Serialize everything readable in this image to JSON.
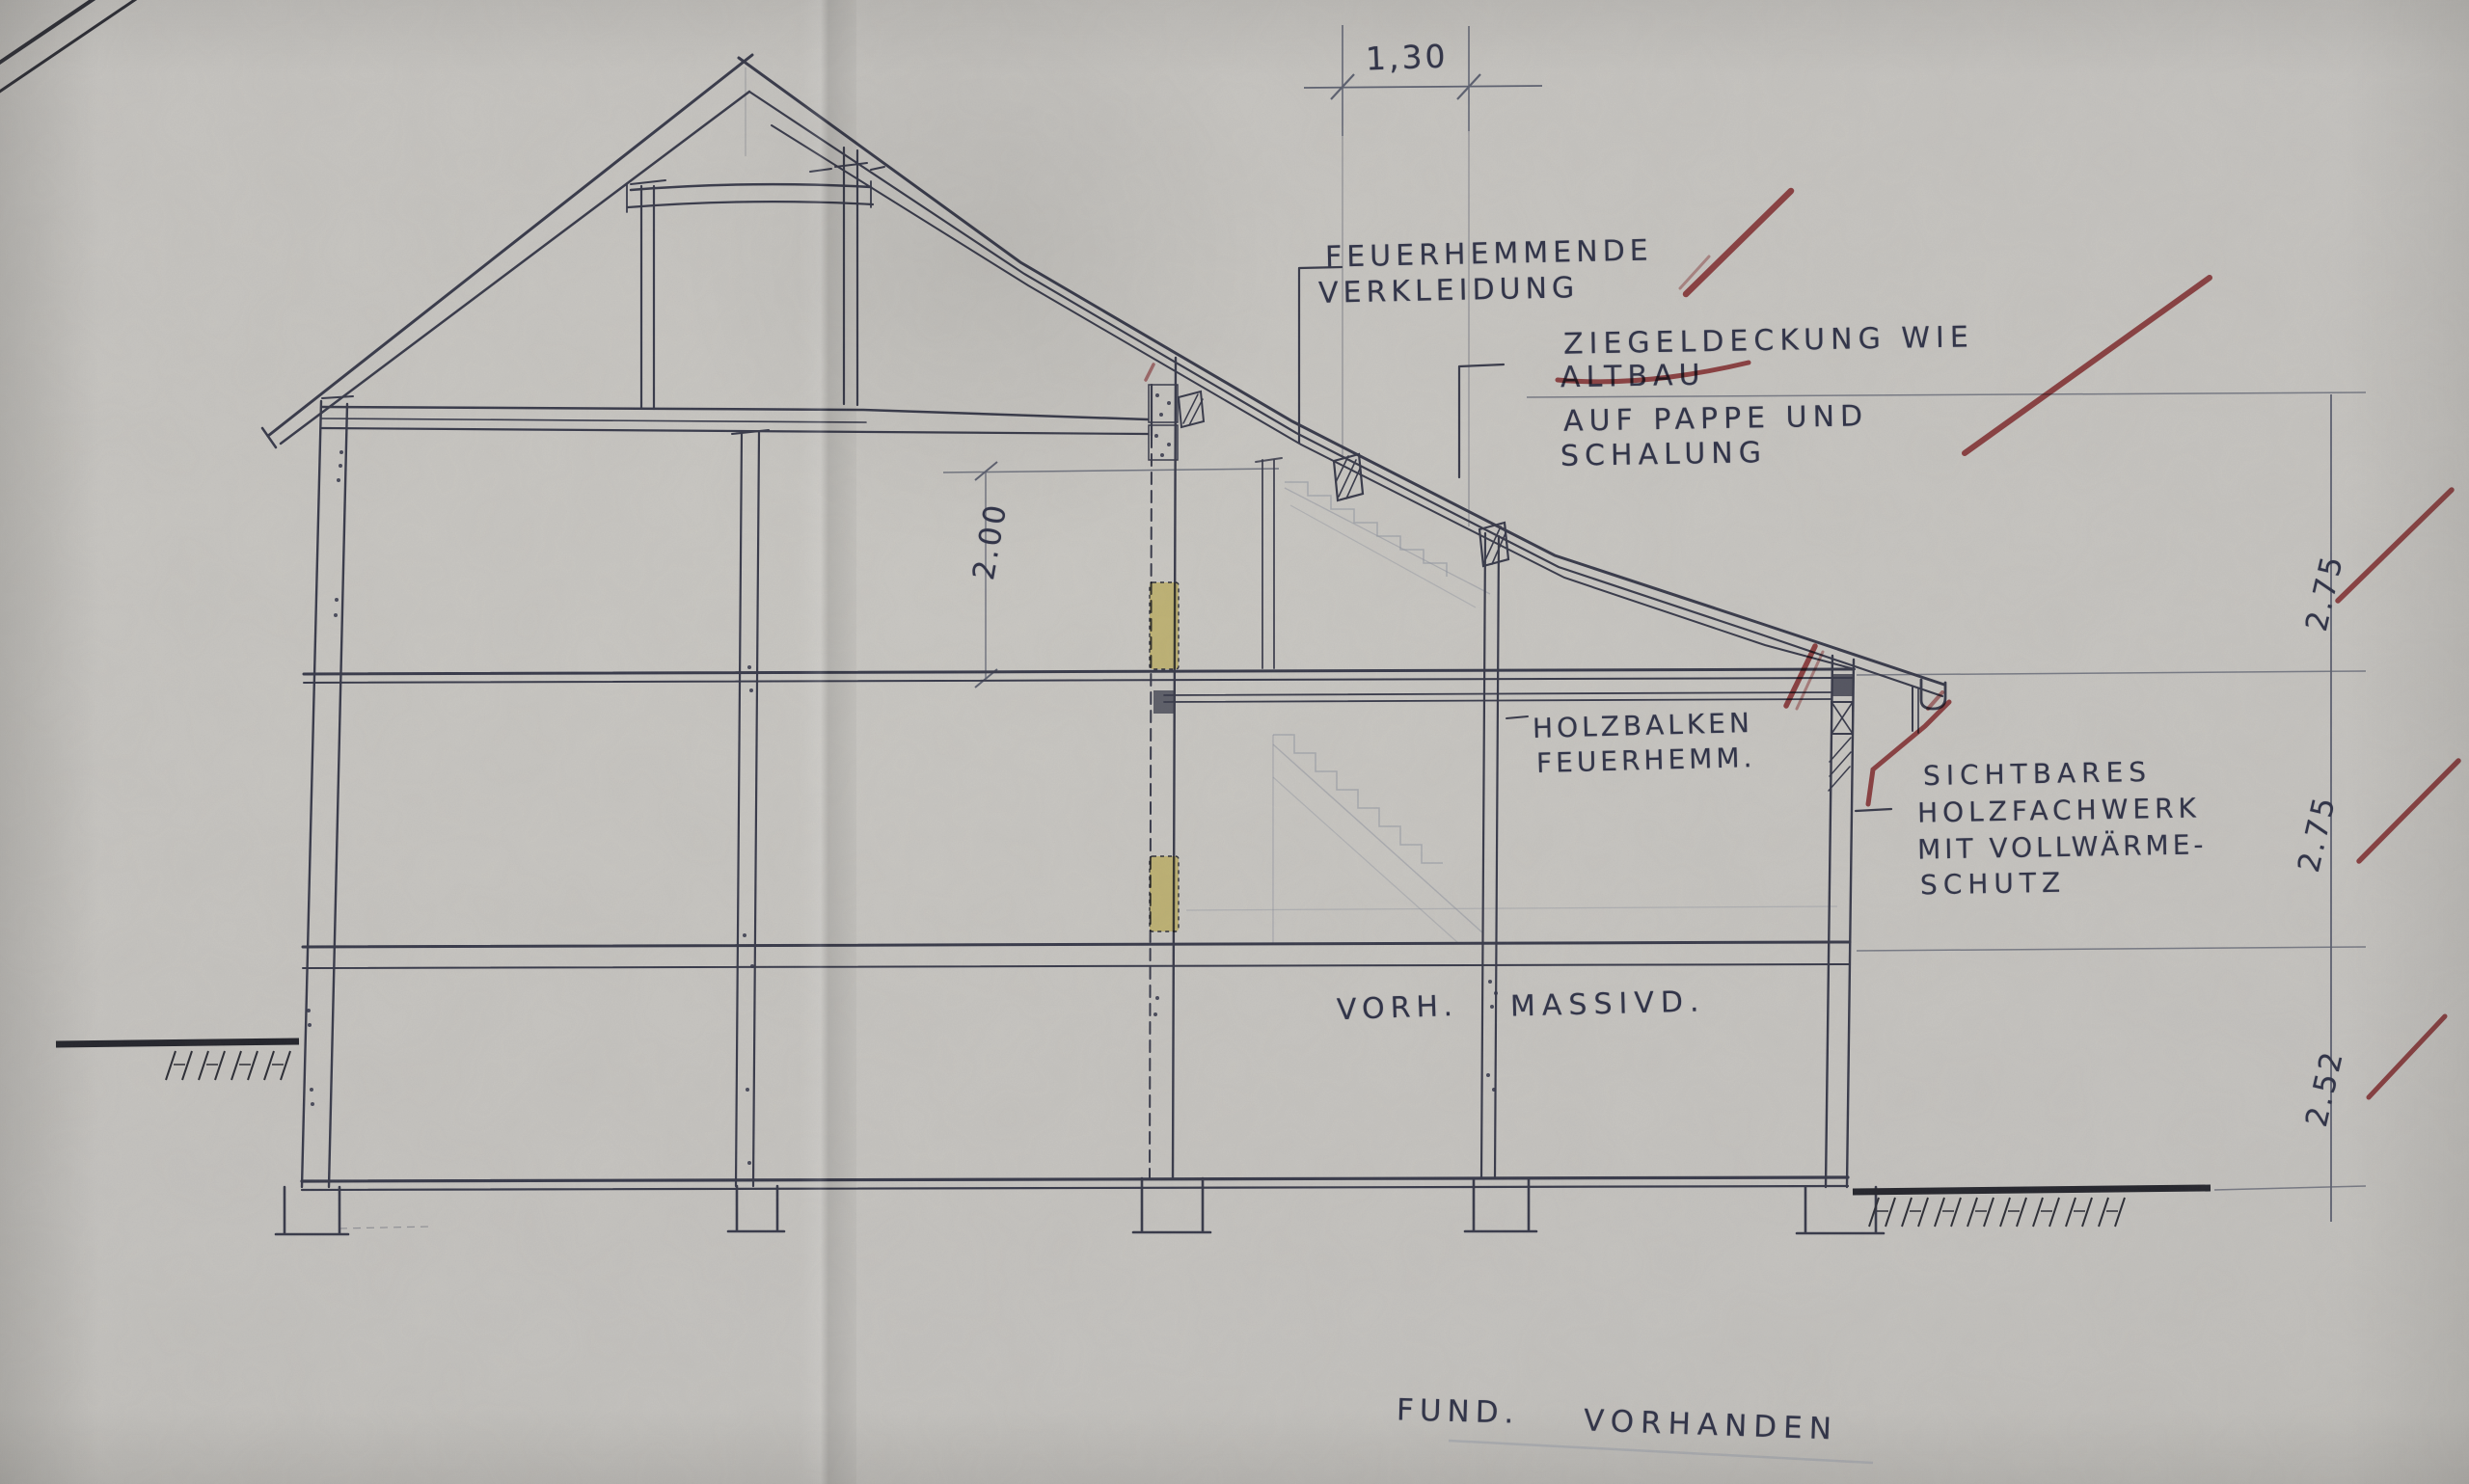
{
  "drawing_title": "building cross-section sketch (scanned hand drawing)",
  "labels": {
    "feuerhemmende": {
      "line1": "FEUERHEMMENDE",
      "line2": "VERKLEIDUNG"
    },
    "ziegeldeckung": {
      "line1": "ZIEGELDECKUNG WIE",
      "line2": "ALTBAU",
      "line3": "AUF PAPPE UND",
      "line4": "SCHALUNG"
    },
    "holzbalken": {
      "line1": "HOLZBALKEN",
      "line2": "FEUERHEMM."
    },
    "sichtbares": {
      "line1": "SICHTBARES",
      "line2": "HOLZFACHWERK",
      "line3": "MIT VOLLWÄRME-",
      "line4": "SCHUTZ"
    },
    "vorh": "VORH.",
    "massivd": "MASSIVD.",
    "fund": "FUND.",
    "vorhanden": "VORHANDEN"
  },
  "dimensions": {
    "top_width": "1,30",
    "room_height": "2.00",
    "storey_top": "2.75",
    "storey_middle": "2.75",
    "storey_bottom": "2.52"
  },
  "marks": {
    "altbau_strikethrough_color": "#a23337",
    "red_check_marks": 8,
    "yellow_highlight_bars": 2
  },
  "colors": {
    "paper": "#c6c4c0",
    "ink": "#383a4a",
    "pencil": "#70747e",
    "red_mark": "#a23337",
    "yellow_highlight": "#e7cf45"
  }
}
